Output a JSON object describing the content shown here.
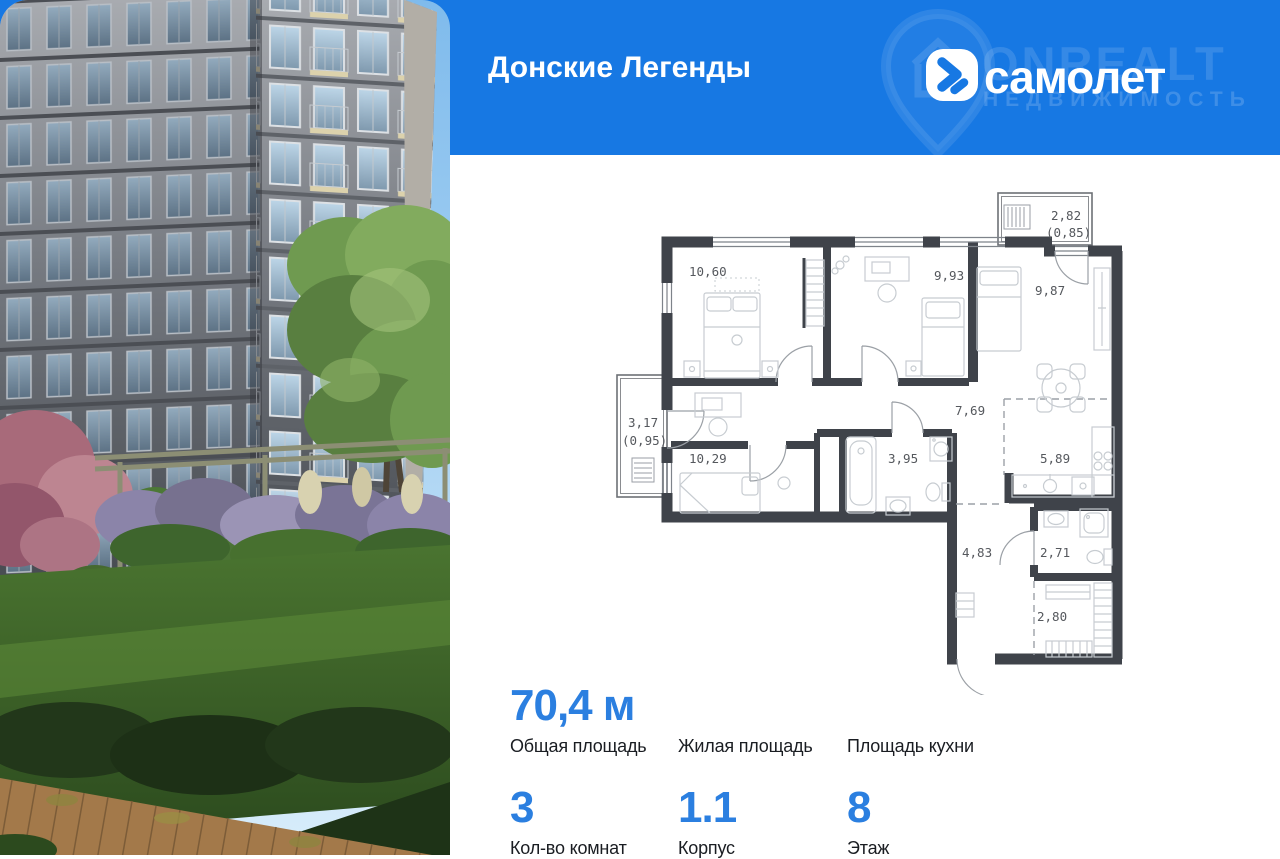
{
  "header": {
    "title": "Донские Легенды",
    "brand": {
      "wordmark": "самолет",
      "watermark_line1": "ONREALT",
      "watermark_line2": "НЕДВИЖИМОСТЬ"
    }
  },
  "floorplan": {
    "rooms": [
      {
        "name": "bedroom-1",
        "area": "10,60"
      },
      {
        "name": "bedroom-2",
        "area": "9,93"
      },
      {
        "name": "living-room",
        "area": "9,87"
      },
      {
        "name": "balcony-top",
        "area": "2,82",
        "coef": "(0,85)"
      },
      {
        "name": "hall",
        "area": "7,69"
      },
      {
        "name": "balcony-left",
        "area": "3,17",
        "coef": "(0,95)"
      },
      {
        "name": "bedroom-3",
        "area": "10,29"
      },
      {
        "name": "bathroom",
        "area": "3,95"
      },
      {
        "name": "kitchen",
        "area": "5,89"
      },
      {
        "name": "entry-hall",
        "area": "4,83"
      },
      {
        "name": "wc",
        "area": "2,71"
      },
      {
        "name": "wardrobe",
        "area": "2,80"
      }
    ]
  },
  "stats": {
    "row1": [
      {
        "value": "70,4 м",
        "label": "Общая площадь"
      },
      {
        "value": "",
        "label": "Жилая площадь"
      },
      {
        "value": "",
        "label": "Площадь кухни"
      }
    ],
    "row2": [
      {
        "value": "3",
        "label": "Кол-во комнат"
      },
      {
        "value": "1.1",
        "label": "Корпус"
      },
      {
        "value": "8",
        "label": "Этаж"
      }
    ]
  },
  "colors": {
    "header_bg": "#1778e3",
    "accent_blue": "#2b7fe0",
    "plan_wall": "#3f434a",
    "plan_label": "#55585d"
  }
}
